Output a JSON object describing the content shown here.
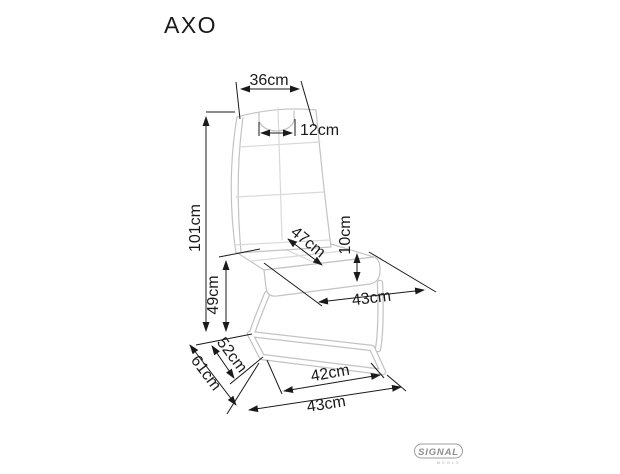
{
  "product": {
    "name": "AXO"
  },
  "dimensions": {
    "backrest_width": "36cm",
    "handle_width": "12cm",
    "total_height": "101cm",
    "seat_diagonal": "47cm",
    "cushion_thickness": "10cm",
    "seat_height": "49cm",
    "seat_width": "43cm",
    "base_depth": "52cm",
    "total_depth": "61cm",
    "front_width": "42cm",
    "base_width": "43cm"
  },
  "logo": {
    "brand": "SIGNAL",
    "subtext": "MEBLE"
  },
  "colors": {
    "dimension_lines": "#1a1a1a",
    "chair_outline": "#c3c3c3",
    "stitching": "#d9d9d9",
    "logo": "#8f8f8f",
    "background": "#ffffff"
  }
}
